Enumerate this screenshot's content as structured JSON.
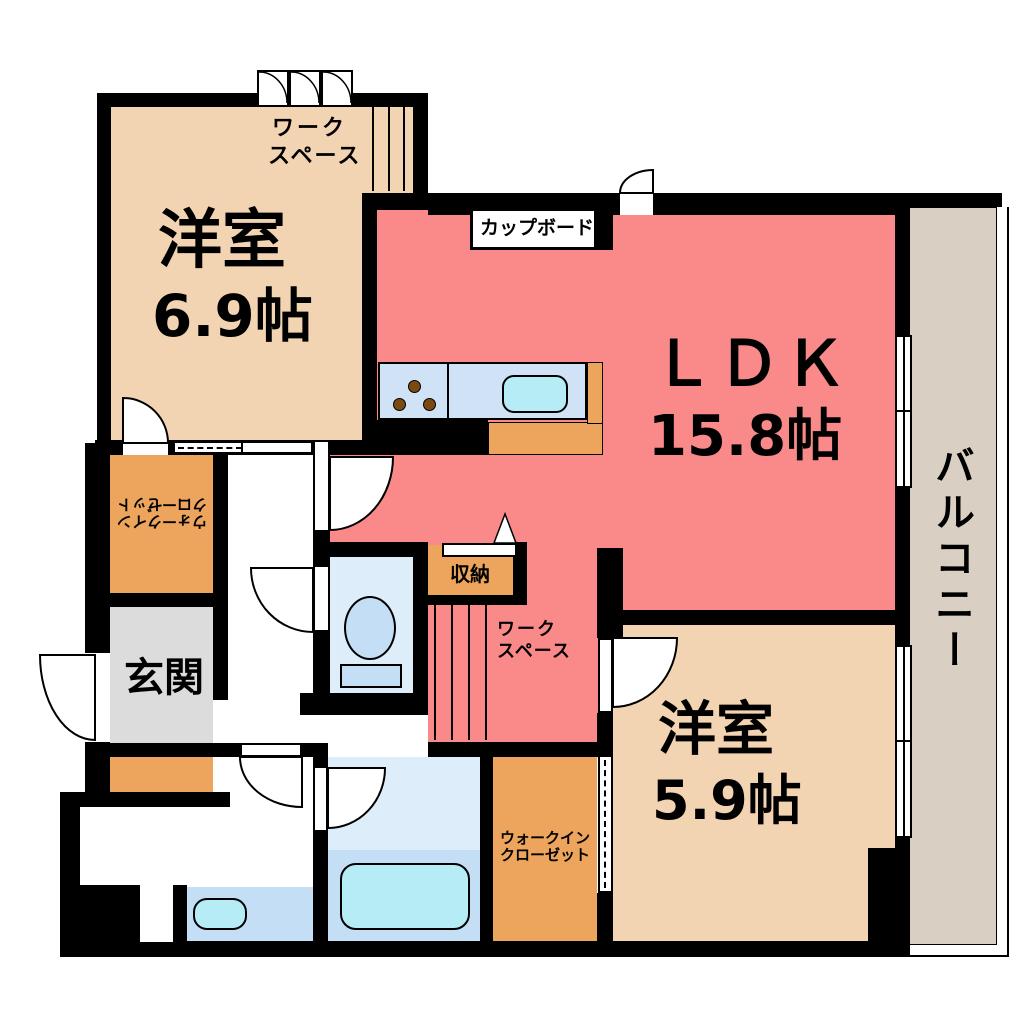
{
  "plan": {
    "bedroom1": {
      "name": "洋室",
      "size": "6.9帖"
    },
    "workspace_top": {
      "line1": "ワーク",
      "line2": "スペース"
    },
    "cupboard_label": "カップボード",
    "ldk": {
      "name": "ＬＤＫ",
      "size": "15.8帖"
    },
    "balcony_label": "バルコニー",
    "storage_label": "収納",
    "workspace_mid": {
      "line1": "ワーク",
      "line2": "スペース"
    },
    "bedroom2": {
      "name": "洋室",
      "size": "5.9帖"
    },
    "entrance_label": "玄関",
    "wic_left": {
      "line1": "ウォークイン",
      "line2": "クローゼット"
    },
    "wic_bottom": {
      "line1": "ウォークイン",
      "line2": "クローゼット"
    },
    "colors": {
      "room_beige": "#f2d4b2",
      "ldk_pink": "#fa8a8a",
      "closet_orange": "#eda55d",
      "entrance_gray": "#dcdcdc",
      "balcony_gray": "#d9d0c3",
      "water_blue": "#cfe2f6",
      "tub_cyan": "#b5ecf5",
      "wall_black": "#000000"
    }
  }
}
